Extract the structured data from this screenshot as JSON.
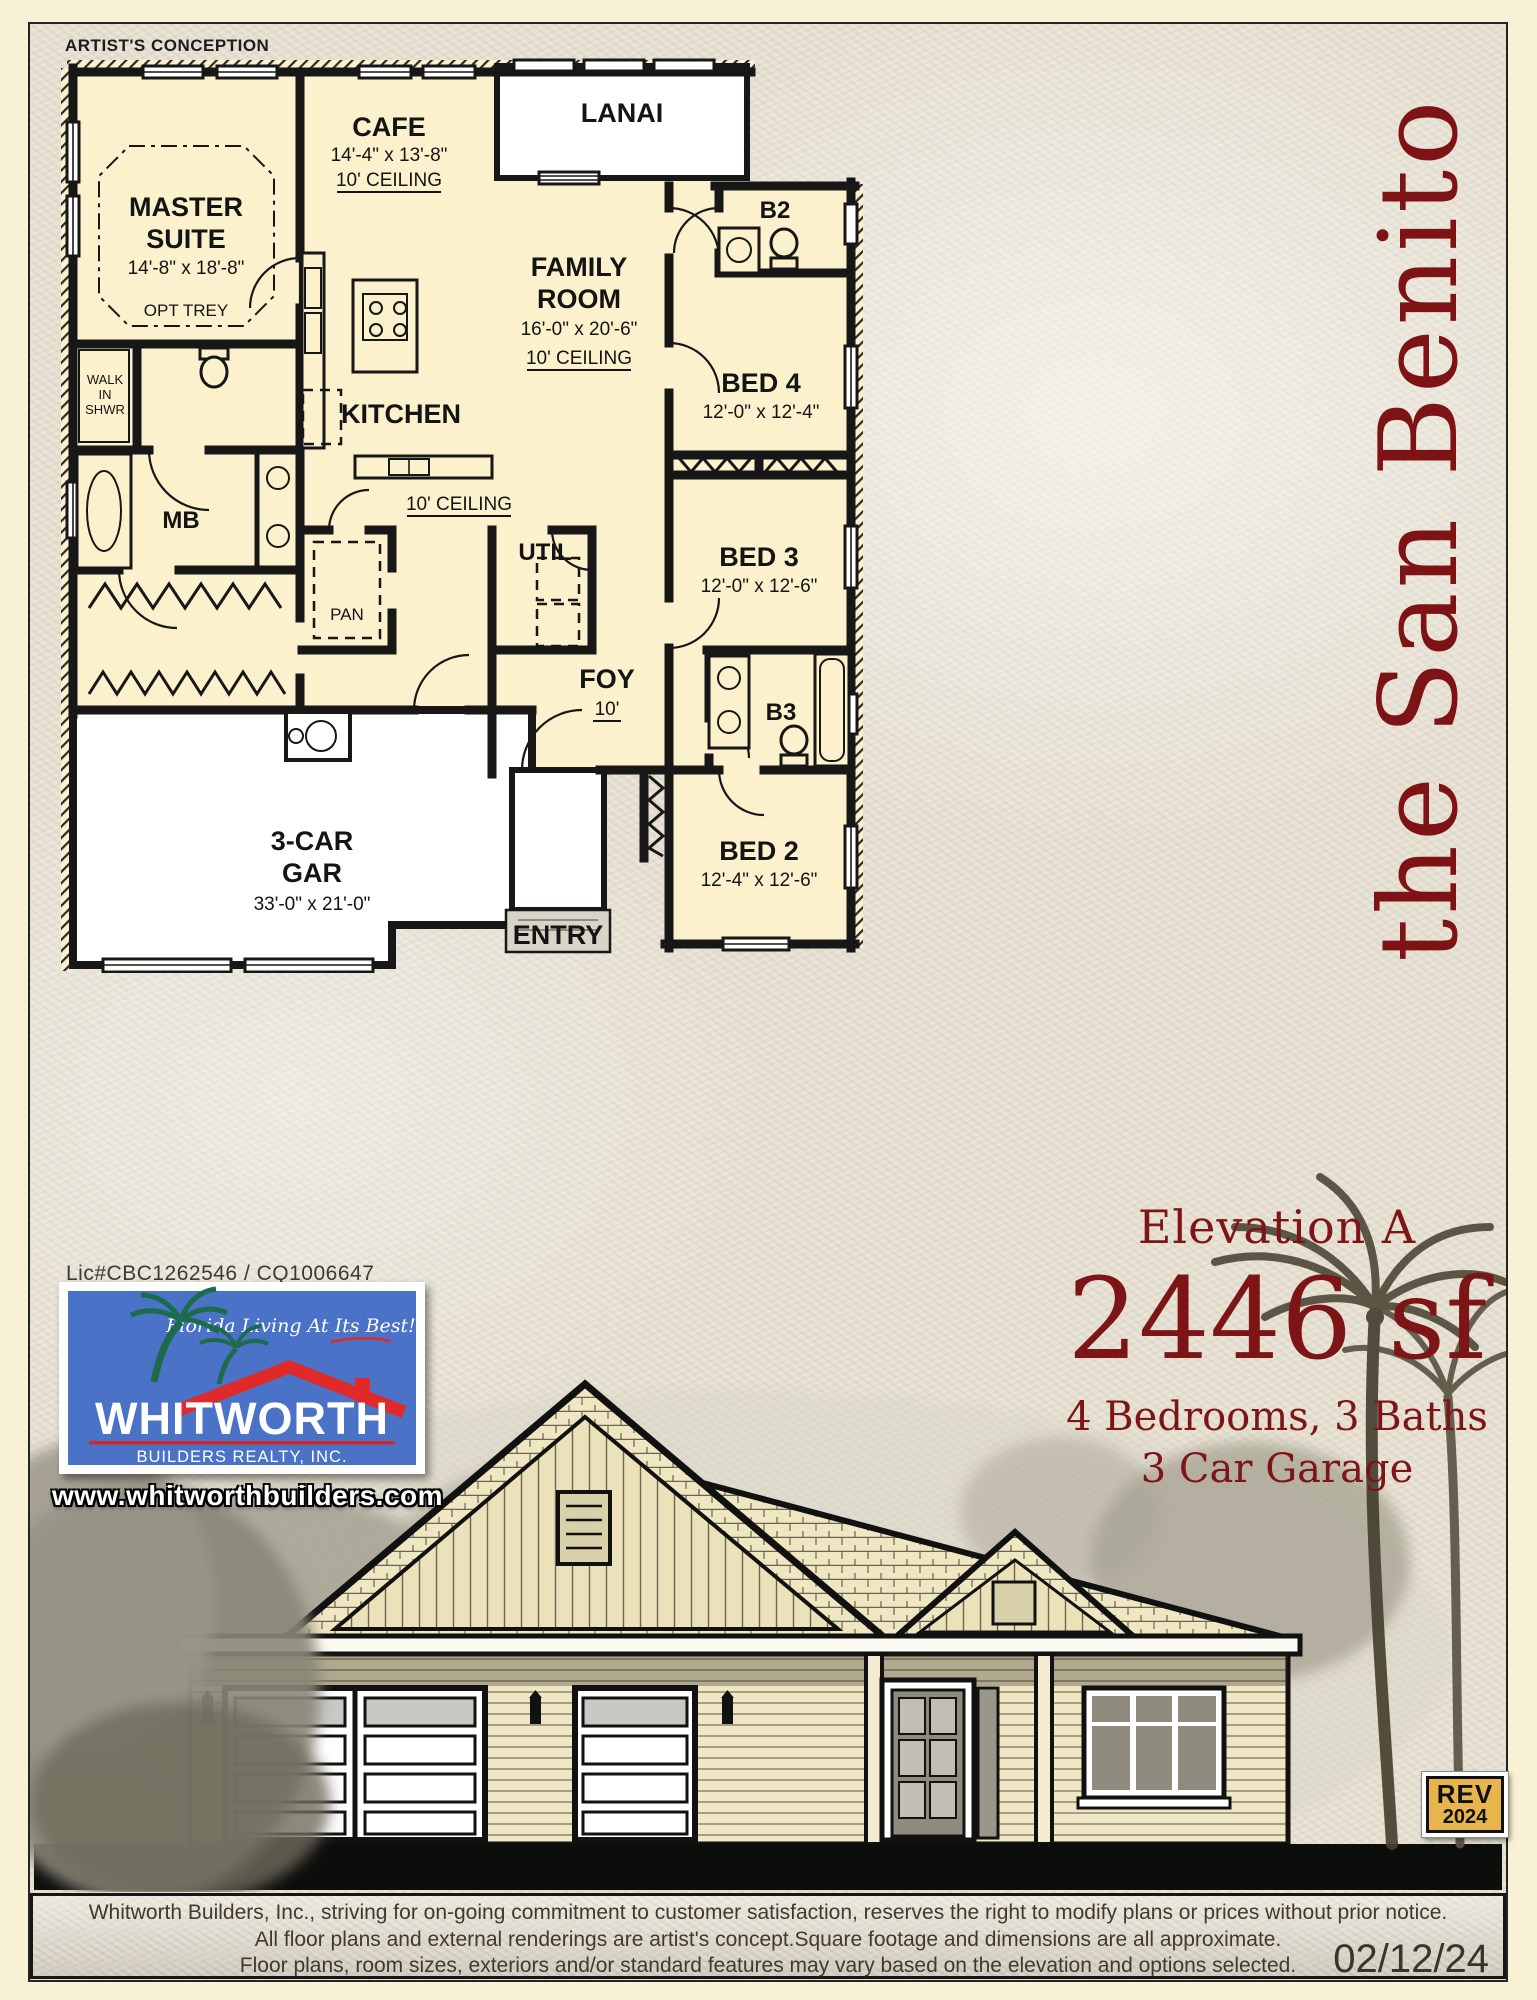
{
  "page": {
    "artists_conception": "ARTIST'S CONCEPTION",
    "model_name": "the San Benito"
  },
  "plan": {
    "master_1": "MASTER",
    "master_2": "SUITE",
    "master_dims": "14'-8\" x 18'-8\"",
    "opt_trey": "OPT TREY",
    "cafe": "CAFE",
    "cafe_dims": "14'-4\" x 13'-8\"",
    "cafe_ceiling": "10' CEILING",
    "lanai": "LANAI",
    "b2": "B2",
    "bed4": "BED 4",
    "bed4_dims": "12'-0\" x 12'-4\"",
    "family_1": "FAMILY",
    "family_2": "ROOM",
    "family_dims": "16'-0\" x 20'-6\"",
    "family_ceiling": "10' CEILING",
    "kitchen": "KITCHEN",
    "walk_1": "WALK",
    "walk_2": "IN",
    "walk_3": "SHWR",
    "mb": "MB",
    "hall_ceiling": "10' CEILING",
    "util": "UTIL",
    "pan": "PAN",
    "foy": "FOY",
    "foy_height": "10'",
    "bed3": "BED 3",
    "bed3_dims": "12'-0\" x 12'-6\"",
    "b3": "B3",
    "bed2": "BED 2",
    "bed2_dims": "12'-4\" x 12'-6\"",
    "gar_1": "3-CAR",
    "gar_2": "GAR",
    "gar_dims": "33'-0\" x 21'-0\"",
    "entry": "ENTRY"
  },
  "info": {
    "elevation": "Elevation A",
    "sqft": "2446 sf",
    "bed_bath": "4 Bedrooms, 3 Baths",
    "garage": "3 Car Garage"
  },
  "branding": {
    "license": "Lic#CBC1262546 / CQ1006647",
    "tagline": "Florida Living At Its Best!",
    "company": "WHITWORTH",
    "company_sub": "BUILDERS REALTY, INC.",
    "website": "www.whitworthbuilders.com"
  },
  "badge": {
    "line1": "REV",
    "line2": "2024"
  },
  "footer": {
    "line1": "Whitworth Builders, Inc., striving for on-going commitment to customer satisfaction, reserves the right to modify plans or prices without prior notice.",
    "line2": "All floor plans and external renderings are artist's concept.Square footage and  dimensions are all approximate.",
    "line3": "Floor plans, room sizes, exteriors and/or  standard features may vary based on the elevation and options selected.",
    "date": "02/12/24"
  },
  "colors": {
    "accent_red": "#7e1316",
    "logo_blue": "#4a72c6",
    "logo_red": "#d92b2b",
    "badge_yellow": "#e8b44c",
    "plan_fill": "#fbf1cd",
    "page_cream": "#f8f1d5"
  }
}
